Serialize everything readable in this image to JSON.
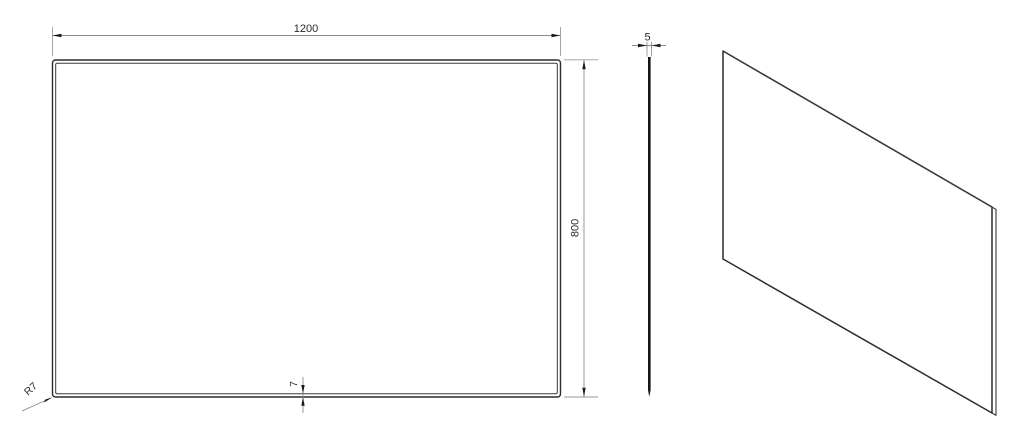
{
  "drawing": {
    "type": "technical-drawing-three-views",
    "dimensions": {
      "width": {
        "value": "1200"
      },
      "height": {
        "value": "800"
      },
      "thickness": {
        "value": "5"
      },
      "bevel": {
        "value": "7"
      },
      "corner_radius": {
        "value": "R7"
      }
    },
    "colors": {
      "background": "#ffffff",
      "outline": "#2d2d2d",
      "dimension_line": "#8c8c8c",
      "arrow": "#1a1a1a",
      "text": "#2b2b2b"
    }
  }
}
